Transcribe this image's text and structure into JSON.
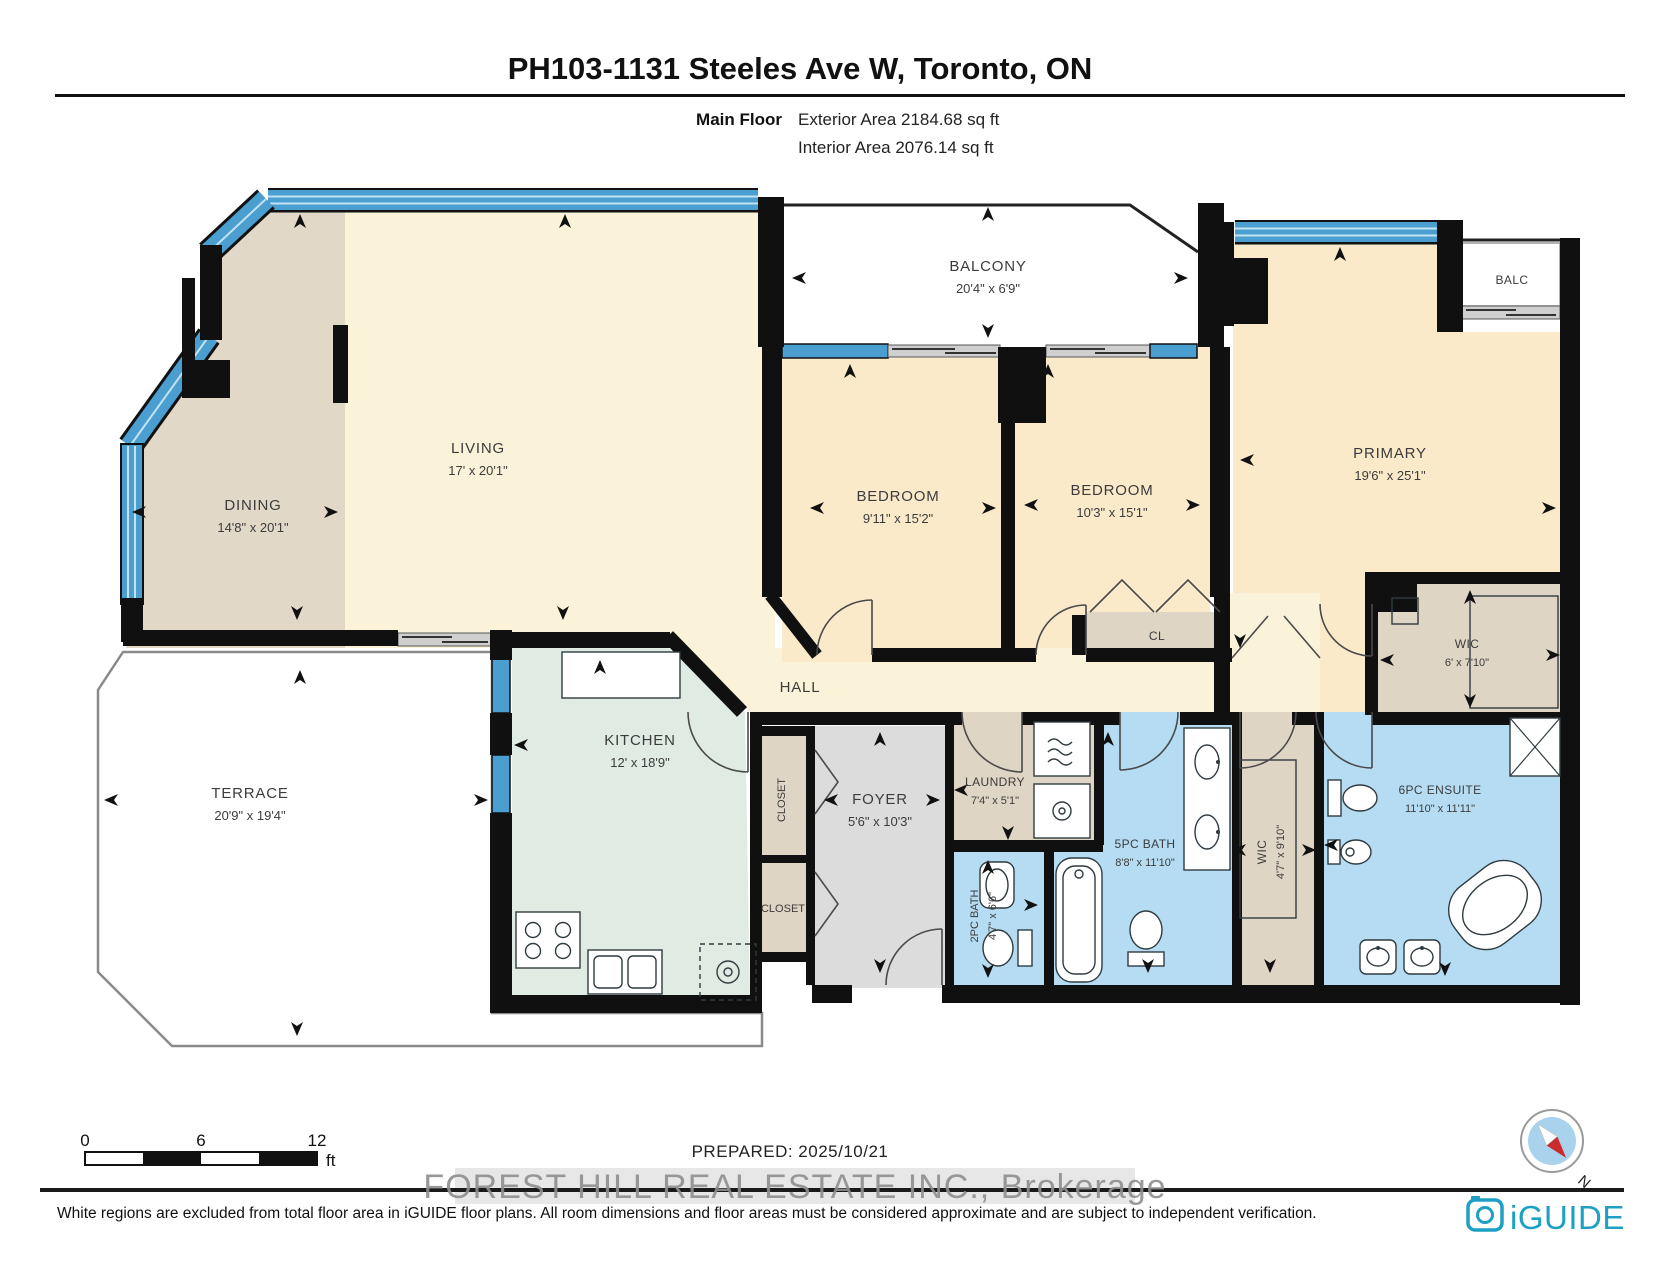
{
  "header": {
    "title": "PH103-1131 Steeles Ave W, Toronto, ON",
    "floor_label": "Main Floor",
    "exterior_area": "Exterior Area 2184.68 sq ft",
    "interior_area": "Interior Area 2076.14 sq ft"
  },
  "rooms": {
    "dining": {
      "name": "DINING",
      "dims": "14'8\" x 20'1\""
    },
    "living": {
      "name": "LIVING",
      "dims": "17' x 20'1\""
    },
    "balcony": {
      "name": "BALCONY",
      "dims": "20'4\" x 6'9\""
    },
    "bedroom1": {
      "name": "BEDROOM",
      "dims": "9'11\" x 15'2\""
    },
    "bedroom2": {
      "name": "BEDROOM",
      "dims": "10'3\" x 15'1\""
    },
    "primary": {
      "name": "PRIMARY",
      "dims": "19'6\" x 25'1\""
    },
    "balc": {
      "name": "BALC"
    },
    "wic_primary": {
      "name": "WIC",
      "dims": "6' x 7'10\""
    },
    "cl": {
      "name": "CL"
    },
    "hall": {
      "name": "HALL"
    },
    "kitchen": {
      "name": "KITCHEN",
      "dims": "12' x 18'9\""
    },
    "terrace": {
      "name": "TERRACE",
      "dims": "20'9\" x 19'4\""
    },
    "closet_upper": {
      "name": "CLOSET"
    },
    "closet_lower": {
      "name": "CLOSET"
    },
    "foyer": {
      "name": "FOYER",
      "dims": "5'6\" x 10'3\""
    },
    "laundry": {
      "name": "LAUNDRY",
      "dims": "7'4\" x 5'1\""
    },
    "bath_2pc": {
      "name": "2PC BATH",
      "dims": "4'7\" x 6'6\""
    },
    "bath_5pc": {
      "name": "5PC BATH",
      "dims": "8'8\" x 11'10\""
    },
    "wic_hall": {
      "name": "WIC",
      "dims": "4'7\" x 9'10\""
    },
    "ensuite": {
      "name": "6PC ENSUITE",
      "dims": "11'10\" x 11'11\""
    }
  },
  "footer": {
    "scale": {
      "t0": "0",
      "t6": "6",
      "t12": "12",
      "unit": "ft"
    },
    "prepared": "PREPARED: 2025/10/21",
    "watermark": "FOREST HILL REAL ESTATE INC., Brokerage",
    "disclaimer": "White regions are excluded from total floor area in iGUIDE floor plans. All room dimensions and floor areas must be considered approximate and are subject to independent verification.",
    "brand": "iGUIDE",
    "compass_north": "N"
  },
  "colors": {
    "window_blue": "#4A9FD0",
    "window_stripe": "#C2E2F2",
    "bath_blue": "#B5DCF2",
    "living_cream": "#FBF3D9",
    "bedroom_cream": "#FAEACA",
    "dining_tan": "#E1D8C8",
    "kitchen_green": "#E0EBE3",
    "closet_beige": "#DFD5C4",
    "foyer_gray": "#DCDCDC",
    "wall_black": "#101010",
    "brand_teal": "#1E9FC6",
    "compass_red": "#CC2B2B"
  }
}
